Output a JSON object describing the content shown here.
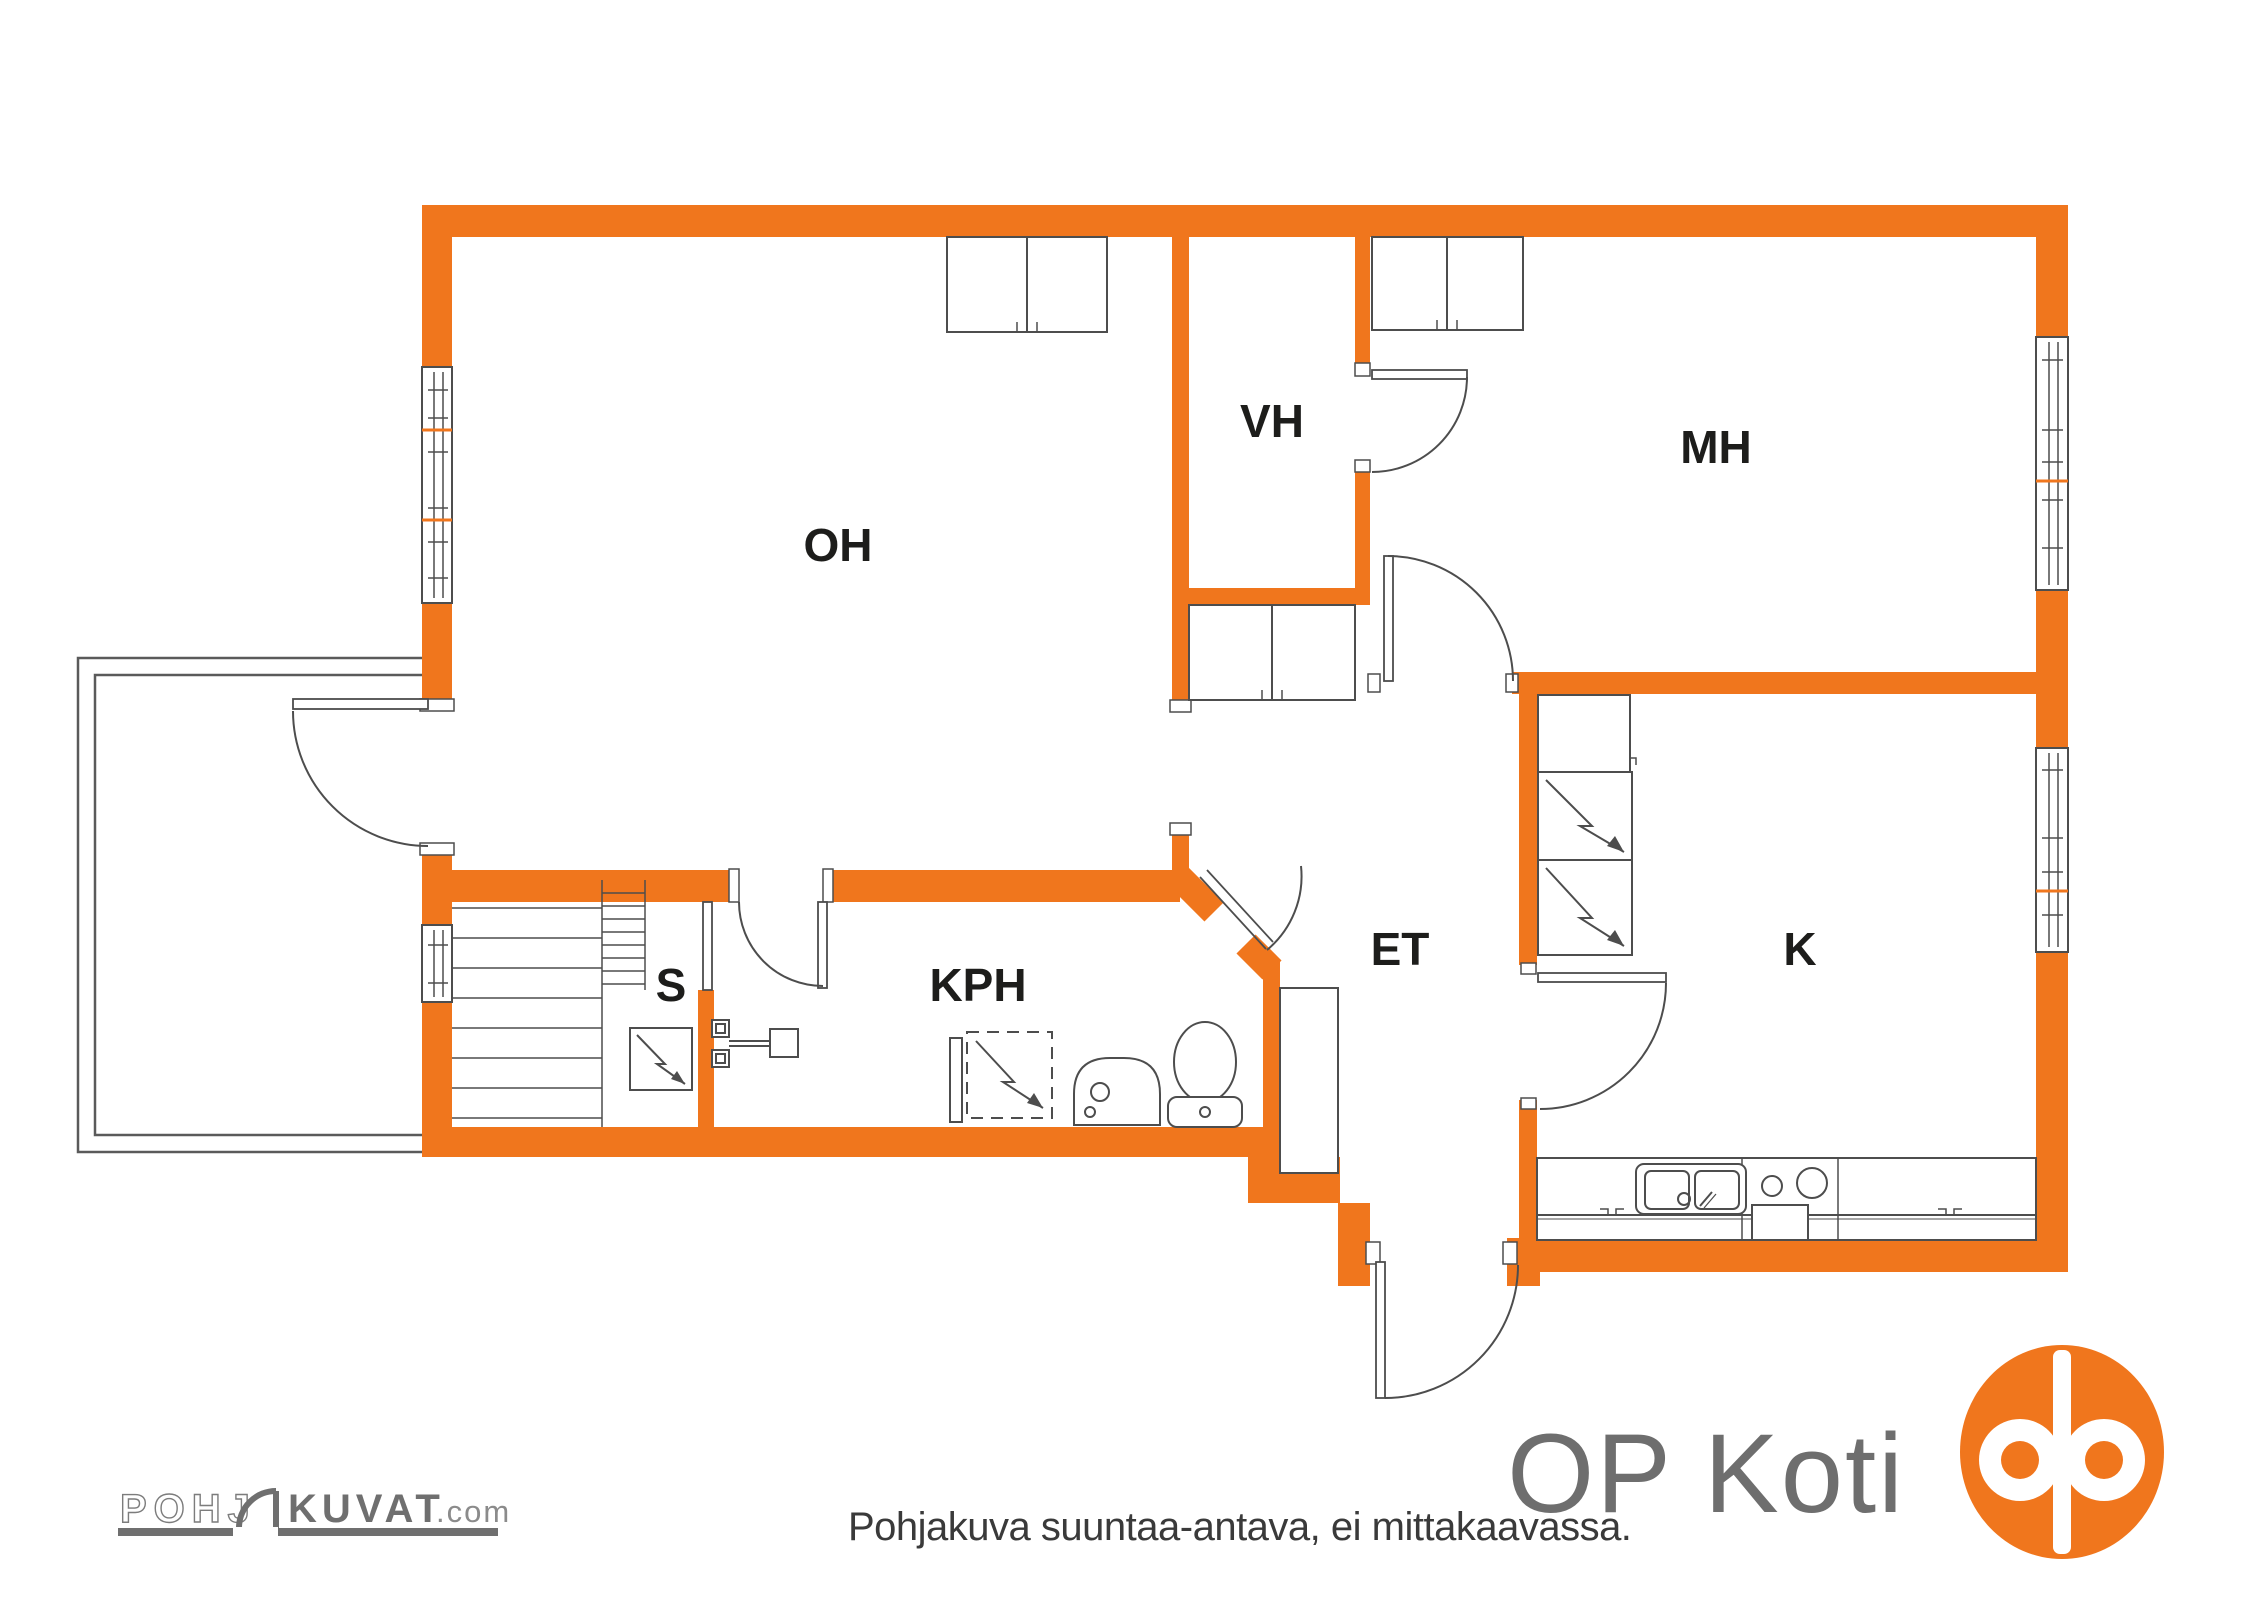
{
  "title": "Floor plan",
  "colors": {
    "wall_orange": "#F0761D",
    "line_gray": "#4d4d4d",
    "label_black": "#1d1d1b",
    "logo_gray": "#6e6e6e",
    "logo_light_gray": "#8b8b8b",
    "disclaimer_gray": "#3a3a3a"
  },
  "rooms": [
    {
      "label": "OH"
    },
    {
      "label": "VH"
    },
    {
      "label": "MH"
    },
    {
      "label": "ET"
    },
    {
      "label": "K"
    },
    {
      "label": "KPH"
    },
    {
      "label": "S"
    }
  ],
  "footer": {
    "disclaimer": "Pohjakuva suuntaa-antava, ei mittakaavassa."
  },
  "branding": {
    "pohjakuvat": {
      "part1": "POHJ",
      "part2": "KUVAT",
      "suffix": ".com"
    },
    "op_koti": {
      "label": "OP Koti"
    }
  }
}
